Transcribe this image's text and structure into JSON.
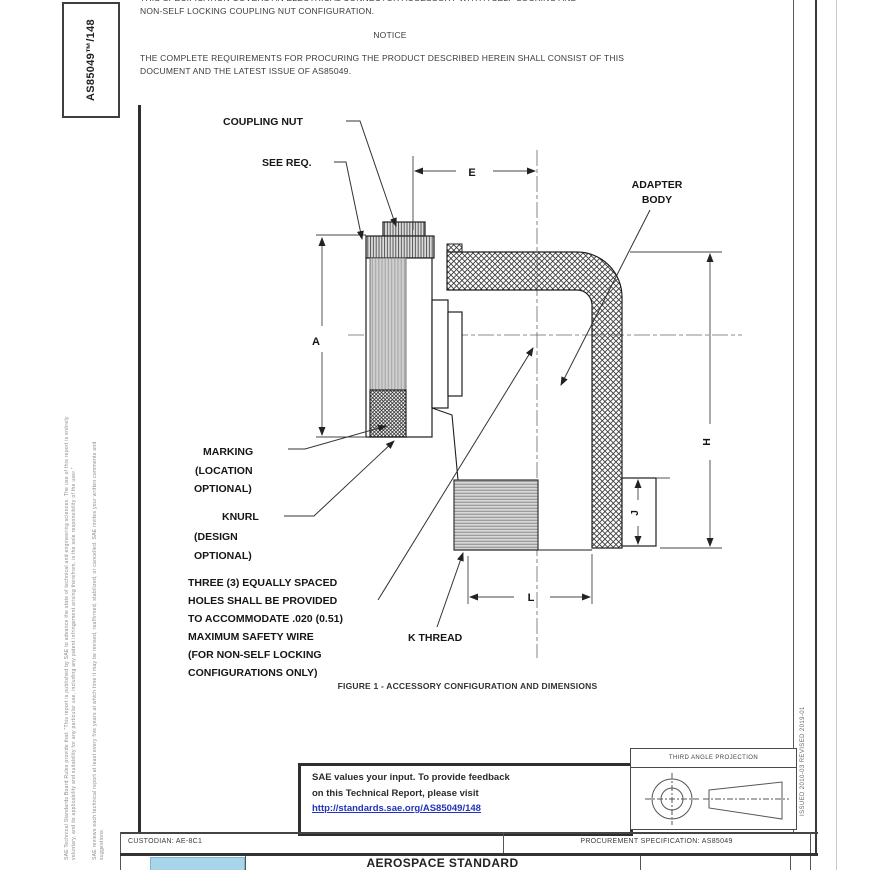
{
  "header": {
    "clipped_line": "THIS SPECIFICATION COVERS AN ELECTRICAL CONNECTOR ACCESSORY WITH A SELF-LOCKING AND",
    "line2": "NON-SELF LOCKING COUPLING NUT CONFIGURATION.",
    "notice_title": "NOTICE",
    "notice_body": "THE COMPLETE REQUIREMENTS FOR PROCURING THE PRODUCT DESCRIBED HEREIN SHALL CONSIST OF THIS DOCUMENT AND THE LATEST ISSUE OF AS85049."
  },
  "left_margin": {
    "doc_number": "AS85049™/148",
    "disclaimer_line1": "SAE Technical Standards Board Rules provide that: “This report is published by SAE to advance the state of technical and engineering sciences. The use of this report is entirely",
    "disclaimer_line2": "voluntary, and its applicability and suitability for any particular use, including any patent infringement arising therefrom, is the sole responsibility of the user.”",
    "disclaimer_line3": "SAE reviews each technical report at least every five years at which time it may be revised, reaffirmed, stabilized, or cancelled. SAE invites your written comments and",
    "disclaimer_line4": "suggestions."
  },
  "right_margin": {
    "issued_revised": "ISSUED 2010-03      REVISED 2019-01"
  },
  "figure": {
    "labels": {
      "coupling_nut": "COUPLING NUT",
      "see_req": "SEE REQ.",
      "adapter_body_1": "ADAPTER",
      "adapter_body_2": "BODY",
      "marking_1": "MARKING",
      "marking_2": "(LOCATION",
      "marking_3": "OPTIONAL)",
      "knurl_1": "KNURL",
      "knurl_2": "(DESIGN",
      "knurl_3": "OPTIONAL)",
      "k_thread": "K THREAD",
      "dim_a": "A",
      "dim_e": "E",
      "dim_h": "H",
      "dim_j": "J",
      "dim_l": "L"
    },
    "note_lines": [
      "THREE (3) EQUALLY SPACED",
      "HOLES SHALL BE PROVIDED",
      "TO ACCOMMODATE .020 (0.51)",
      "MAXIMUM SAFETY WIRE",
      "(FOR NON-SELF LOCKING",
      "CONFIGURATIONS ONLY)"
    ],
    "caption": "FIGURE 1 - ACCESSORY CONFIGURATION AND DIMENSIONS"
  },
  "feedback_box": {
    "line1": "SAE values your input. To provide feedback",
    "line2": "on this Technical Report, please visit",
    "link": "http://standards.sae.org/AS85049/148"
  },
  "projection_box": {
    "title": "THIRD ANGLE PROJECTION"
  },
  "footer": {
    "custodian": "CUSTODIAN: AE-8C1",
    "procurement": "PROCUREMENT SPECIFICATION: AS85049",
    "doc_type": "AEROSPACE STANDARD"
  },
  "colors": {
    "link_blue": "#2233bb",
    "logo_blue": "#a7d6ea"
  }
}
